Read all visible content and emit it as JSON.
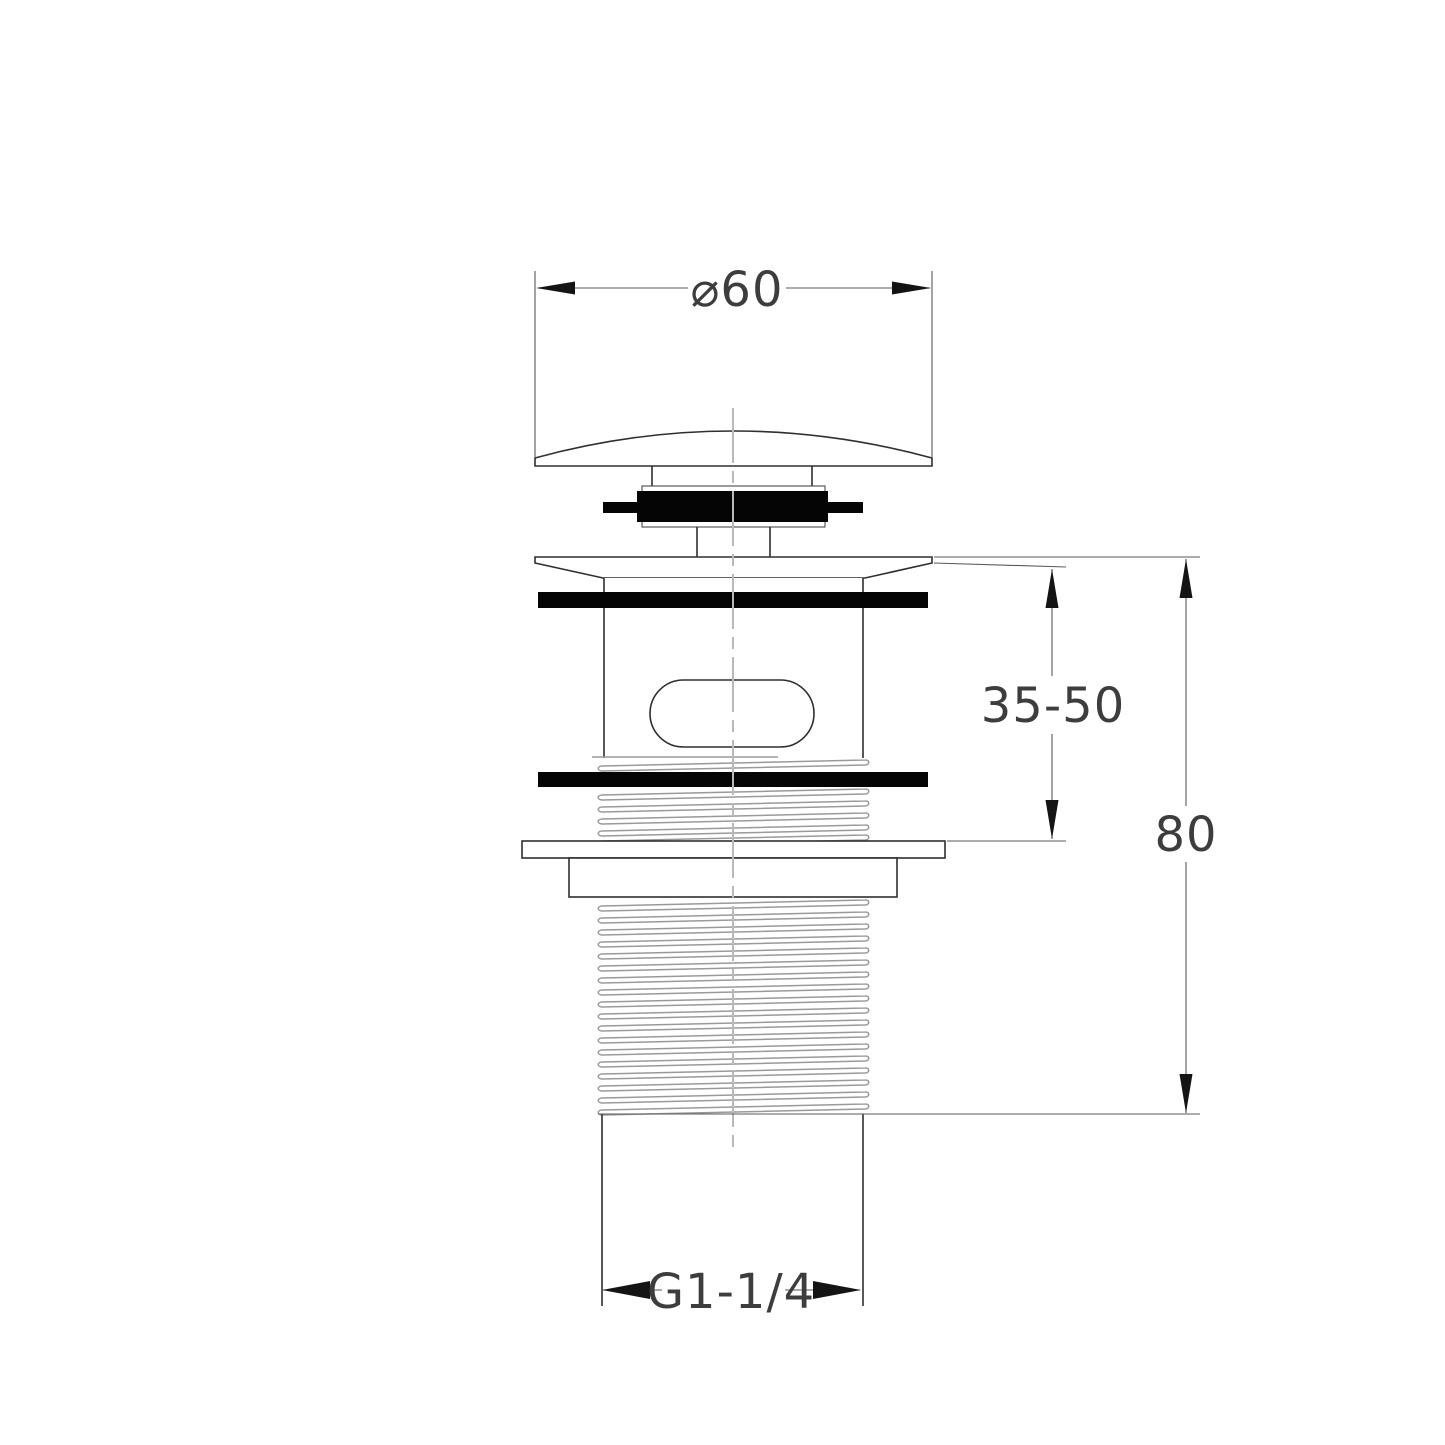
{
  "drawing": {
    "background": "#ffffff",
    "colors": {
      "outline": "#2f2f2f",
      "dimension_line": "#5a5a5a",
      "thread_line": "#9a9a9a",
      "centerline": "#b9b9b9",
      "rubber_seal": "#050505",
      "text": "#3d3d3d"
    },
    "dimensions": {
      "cap_diameter": "⌀60",
      "adjustable_range": "35-50",
      "overall_height": "80",
      "thread_size": "G1-1/4"
    }
  }
}
